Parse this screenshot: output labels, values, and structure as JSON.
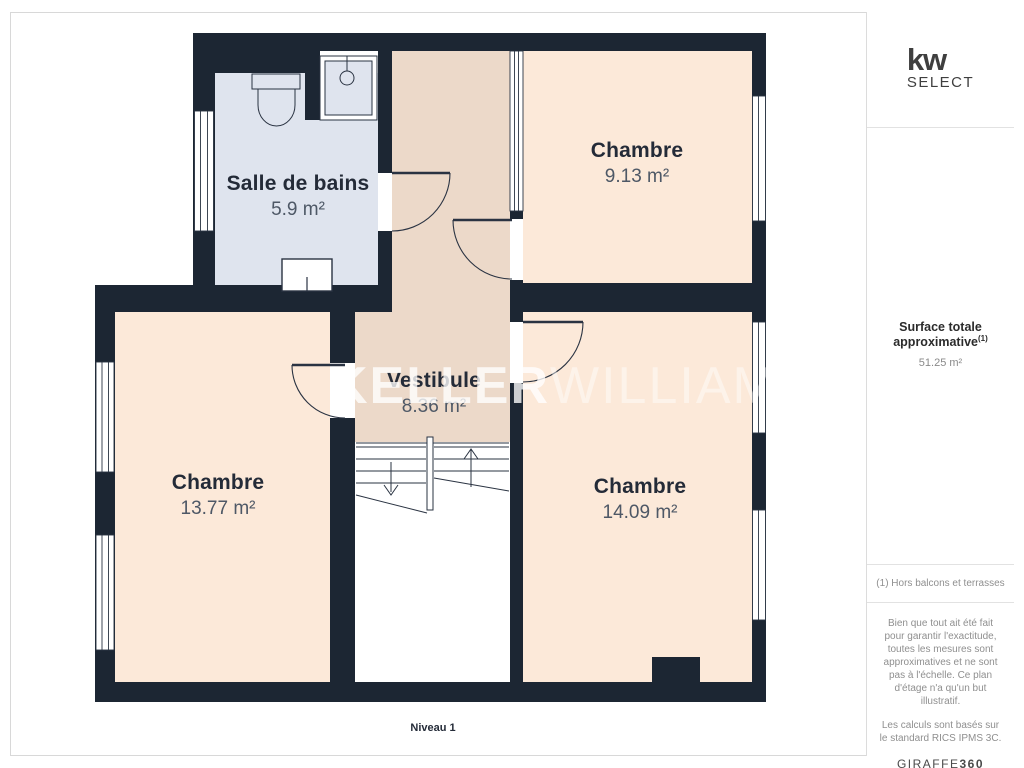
{
  "branding": {
    "logo_main": "kw",
    "logo_sub": "SELECT"
  },
  "floor_label": "Niveau 1",
  "watermark": {
    "part1": "KELLER",
    "part2": "WILLIAMS"
  },
  "rooms": [
    {
      "name": "Salle de bains",
      "area": "5.9 m²"
    },
    {
      "name": "Chambre",
      "area": "9.13 m²"
    },
    {
      "name": "Vestibule",
      "area": "8.36 m²"
    },
    {
      "name": "Chambre",
      "area": "13.77 m²"
    },
    {
      "name": "Chambre",
      "area": "14.09 m²"
    }
  ],
  "summary": {
    "title": "Surface totale approximative",
    "note": "(1)",
    "value": "51.25 m²"
  },
  "footnote": "(1) Hors balcons et terrasses",
  "disclaimer": {
    "p1": "Bien que tout ait été fait pour garantir l'exactitude, toutes les mesures sont approximatives et ne sont pas à l'échelle. Ce plan d'étage n'a qu'un but illustratif.",
    "p2": "Les calculs sont basés sur le standard RICS IPMS 3C."
  },
  "provider": {
    "name": "GIRAFFE",
    "suffix": "360"
  },
  "colors": {
    "wall": "#1c2633",
    "bedroom_fill": "#fce9d9",
    "vestibule_fill": "#ecd9c9",
    "bathroom_fill": "#dfe4ee",
    "room_name_text": "#242b38",
    "room_area_text": "#4e5866",
    "watermark_text": "#ffffff",
    "sidebar_text": "#8f8f8f",
    "line": "#2a3342"
  }
}
